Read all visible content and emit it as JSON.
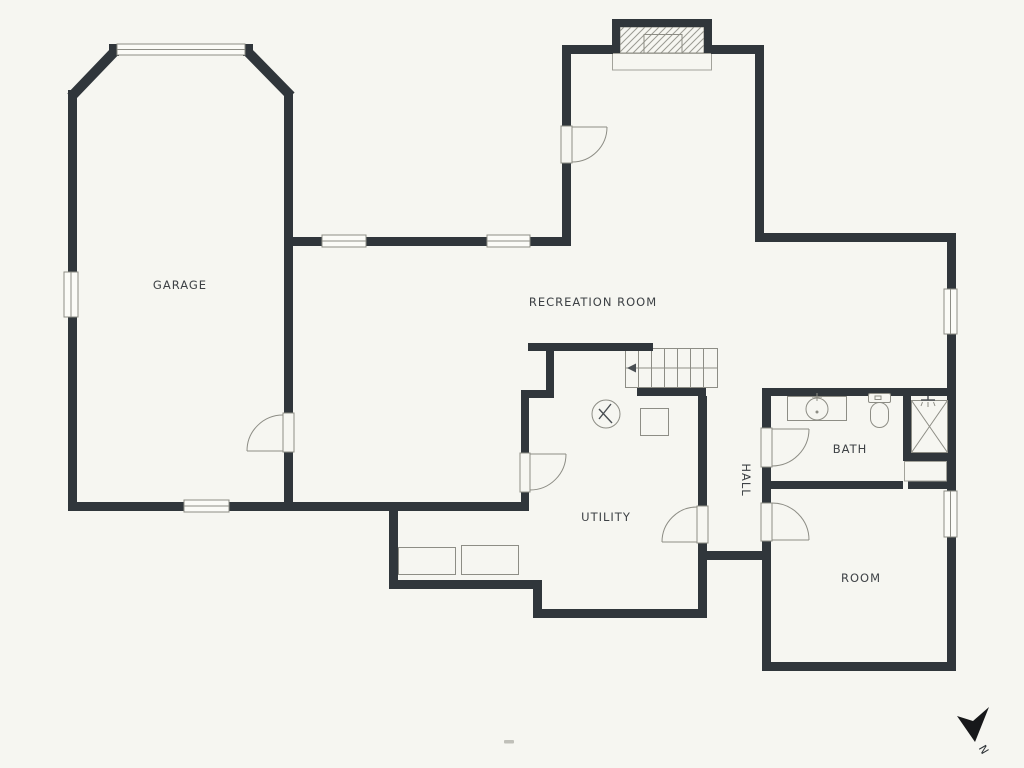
{
  "document": {
    "type": "basement-floor-plan"
  },
  "labels": {
    "garage": "GARAGE",
    "recreation_room": "RECREATION ROOM",
    "utility": "UTILITY",
    "hall": "HALL",
    "bath": "BATH",
    "room": "ROOM"
  },
  "compass": {
    "north_label": "N"
  },
  "colors": {
    "background": "#f6f6f1",
    "wall": "#30363b",
    "thin_line": "#8d8d85",
    "text": "#3d4145"
  },
  "icons": {
    "north_arrow": "concave-dart",
    "stairs_upper": "hatched-stair-run",
    "stairs_main": "tread-lines-with-arrow",
    "water_heater": "circle-with-zigzag",
    "sink": "circle-in-counter",
    "toilet": "tank-and-bowl",
    "shower": "crossed-square",
    "window": "double-line-band",
    "door": "quarter-arc-swing"
  }
}
